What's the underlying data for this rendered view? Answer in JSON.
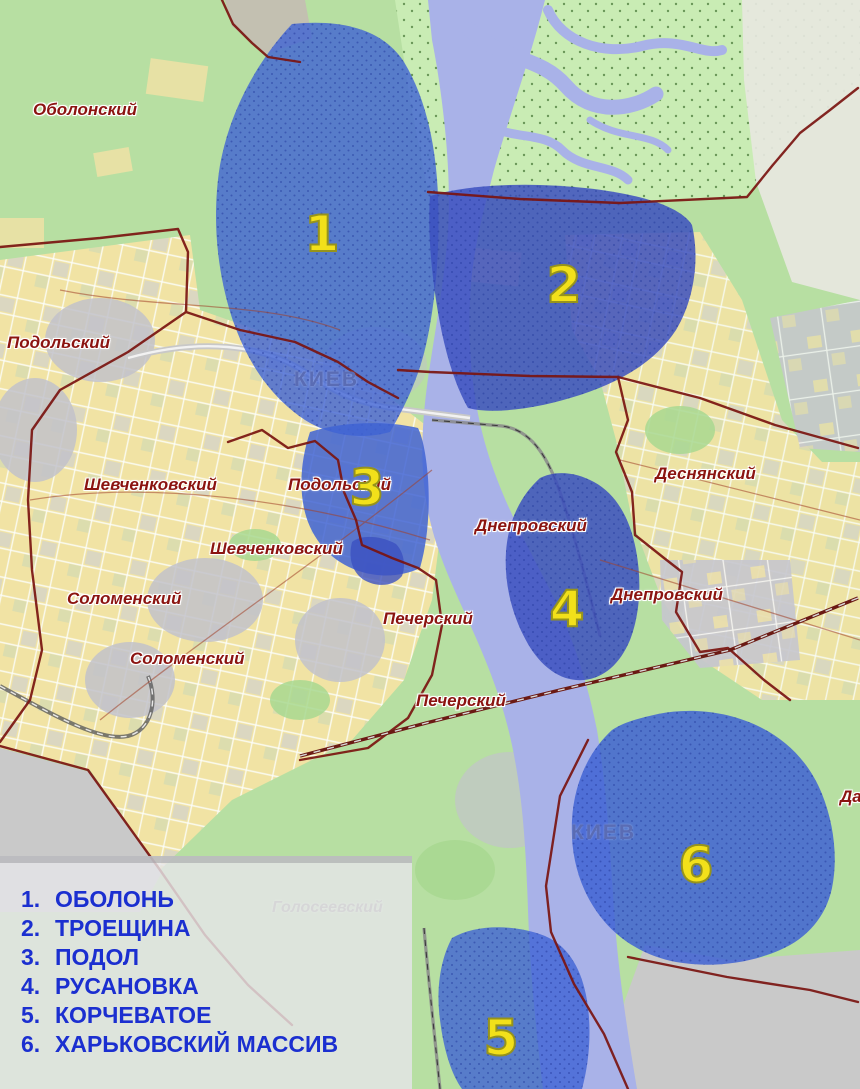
{
  "map": {
    "city_labels": {
      "north": "КИЕВ",
      "south": "КИЕВ"
    },
    "district_labels": [
      {
        "id": "obolonsky",
        "text": "Оболонский"
      },
      {
        "id": "podolsky-1",
        "text": "Подольский"
      },
      {
        "id": "shevchenkovsky-1",
        "text": "Шевченковский"
      },
      {
        "id": "podolsky-2",
        "text": "Подольский"
      },
      {
        "id": "shevchenkovsky-2",
        "text": "Шевченковский"
      },
      {
        "id": "solomensky-1",
        "text": "Соломенский"
      },
      {
        "id": "solomensky-2",
        "text": "Соломенский"
      },
      {
        "id": "pechersky-1",
        "text": "Печерский"
      },
      {
        "id": "pechersky-2",
        "text": "Печерский"
      },
      {
        "id": "desnyansky",
        "text": "Деснянский"
      },
      {
        "id": "dneprovsky-1",
        "text": "Днепровский"
      },
      {
        "id": "dneprovsky-2",
        "text": "Днепровский"
      },
      {
        "id": "golosseevsky",
        "text": "Голосеевский"
      },
      {
        "id": "darnitsky-partial",
        "text": "Да"
      }
    ],
    "zone_numbers": [
      "1",
      "2",
      "3",
      "4",
      "5",
      "6"
    ],
    "legend": {
      "items": [
        {
          "num": "1.",
          "name": "ОБОЛОНЬ"
        },
        {
          "num": "2.",
          "name": "ТРОЕЩИНА"
        },
        {
          "num": "3.",
          "name": "ПОДОЛ"
        },
        {
          "num": "4.",
          "name": "РУСАНОВКА"
        },
        {
          "num": "5.",
          "name": "КОРЧЕВАТОЕ"
        },
        {
          "num": "6.",
          "name": "ХАРЬКОВСКИЙ МАССИВ"
        }
      ]
    },
    "colors": {
      "land": "#b7dfa2",
      "forest": "#c9ecb4",
      "urban": "#f3e3a4",
      "urban_gray": "#c6c6ce",
      "river": "#a9b2e8",
      "flood_zone": "#3f63d4",
      "flood_zone_dark": "#3c50c0",
      "border": "#7a1410",
      "district_label": "#8b1410",
      "city_label": "#5a6cb4",
      "zone_number": "#f2e01a",
      "legend_text": "#1b2fd0",
      "legend_bg": "#e5e5e9"
    }
  }
}
